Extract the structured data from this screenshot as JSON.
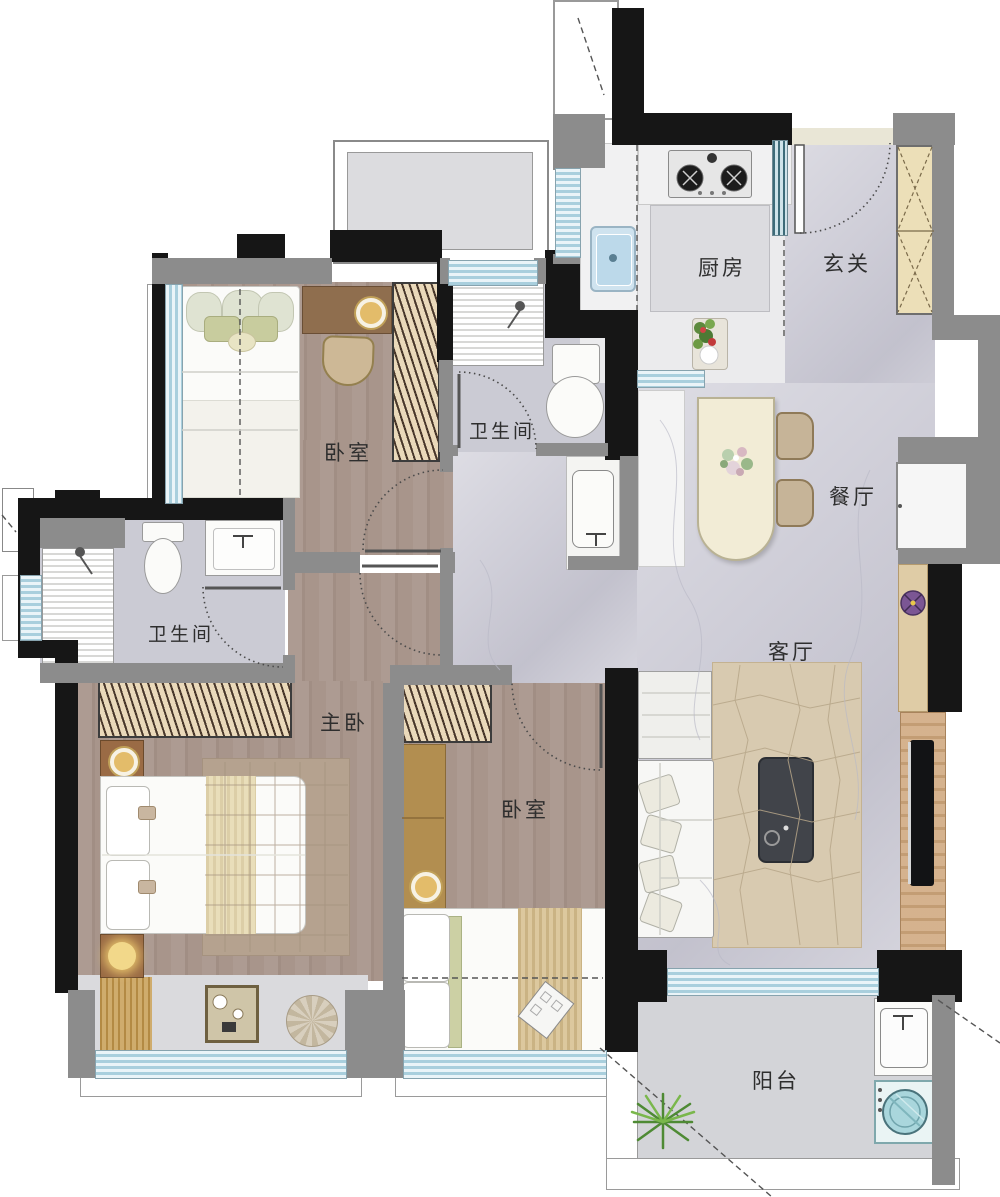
{
  "document": {
    "kind": "residential floor plan",
    "language": "zh-CN"
  },
  "rooms": {
    "kitchen": {
      "label": "厨房"
    },
    "entry": {
      "label": "玄关"
    },
    "bathroom_main": {
      "label": "卫生间"
    },
    "bedroom_north": {
      "label": "卧室"
    },
    "bathroom_master": {
      "label": "卫生间"
    },
    "master_bedroom": {
      "label": "主卧"
    },
    "bedroom_south": {
      "label": "卧室"
    },
    "dining": {
      "label": "餐厅"
    },
    "living": {
      "label": "客厅"
    },
    "balcony": {
      "label": "阳台"
    }
  },
  "fixtures": [
    "double-bed-master",
    "single-bed-north",
    "single-bed-south",
    "wardrobe-north",
    "wardrobe-master",
    "wardrobe-south",
    "desk-north",
    "desk-south",
    "desk-chair",
    "dining-table",
    "dining-chairs",
    "flower-centerpiece",
    "sofa",
    "side-table",
    "coffee-table",
    "area-rug",
    "tv",
    "tv-wood-panel",
    "console-shelf",
    "potted-plant-purple",
    "stove-two-burner",
    "kitchen-sink",
    "kitchen-island",
    "vegetable-basket",
    "shoe-cabinet",
    "fridge-niche",
    "shower-main",
    "toilet-main",
    "vanity-sink-main",
    "shower-master",
    "toilet-master",
    "vanity-sink-master",
    "balcony-sink",
    "washing-machine",
    "balcony-plant",
    "bay-window-seat",
    "tray-with-cups",
    "round-cushion"
  ],
  "palette": {
    "wall_black": "#161616",
    "wall_gray": "#8c8c8c",
    "wood_floor": "#a8958b",
    "marble_floor": "#cfced8",
    "kitchen_floor": "#ebebed",
    "balcony_floor": "#d3d4d8",
    "window_glass": "#a9cfdd",
    "wardrobe_beige": "#ead9ba",
    "dining_table": "#f2ecd6",
    "rug_living": "#d8cab0",
    "rug_master": "#b5a28f",
    "coffee_table": "#41444a",
    "tv_panel_wood": "#cfa87e",
    "desk_wood": "#8f6e4e",
    "washer_teal": "#a8d8de"
  }
}
